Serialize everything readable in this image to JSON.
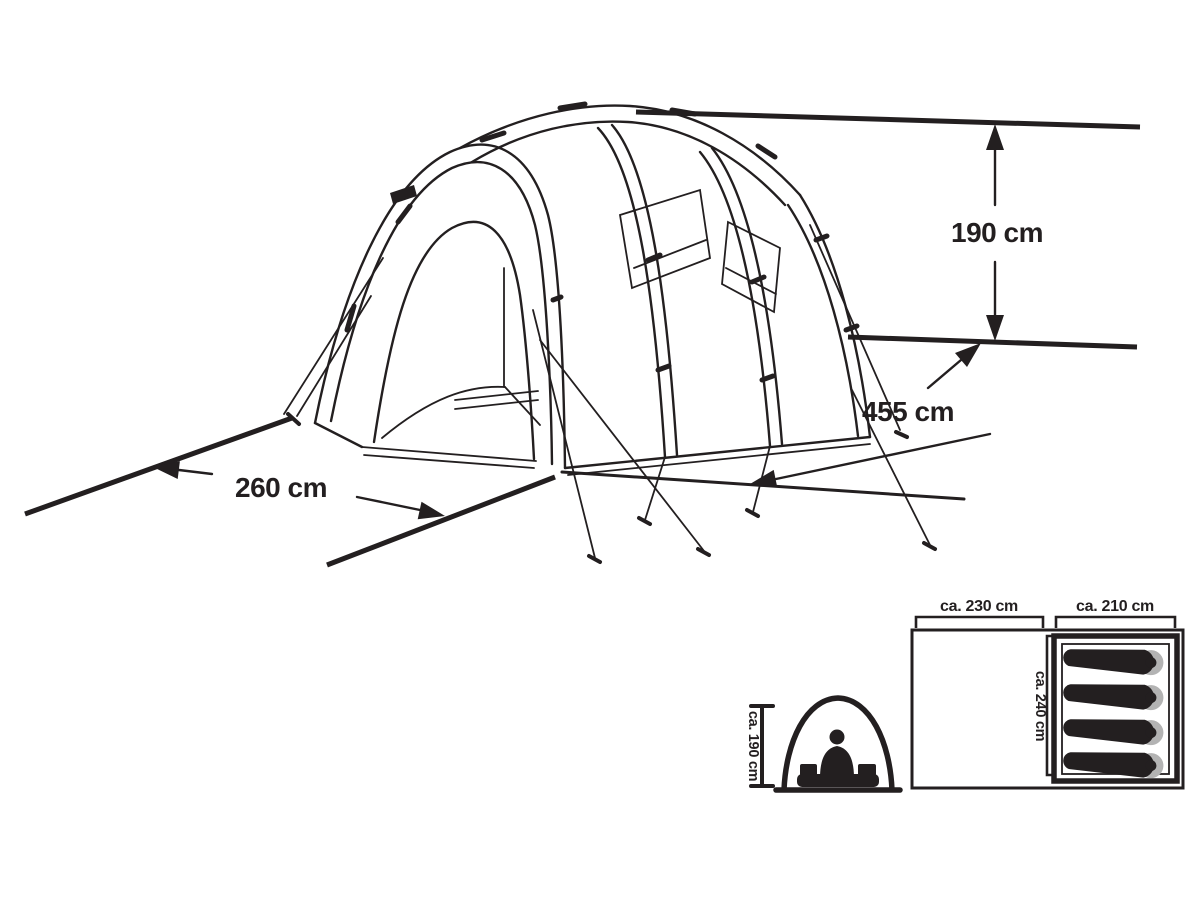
{
  "page": {
    "background": "#ffffff",
    "ink_color": "#231f20",
    "pillow_gray": "#b3b3b3"
  },
  "main_diagram": {
    "description": "isometric line drawing of a tunnel tent with outer dimensions",
    "height_label": "190 cm",
    "length_label": "455 cm",
    "width_label": "260 cm"
  },
  "cross_section": {
    "description": "tent arch cross-section with seated person",
    "height_label": "ca. 190 cm"
  },
  "floor_plan": {
    "description": "top view floor plan with living area and sleeping cabin",
    "front_room_label": "ca. 230 cm",
    "sleeping_room_label": "ca. 210 cm",
    "depth_label": "ca. 240 cm",
    "sleeping_bag_count": 4
  }
}
